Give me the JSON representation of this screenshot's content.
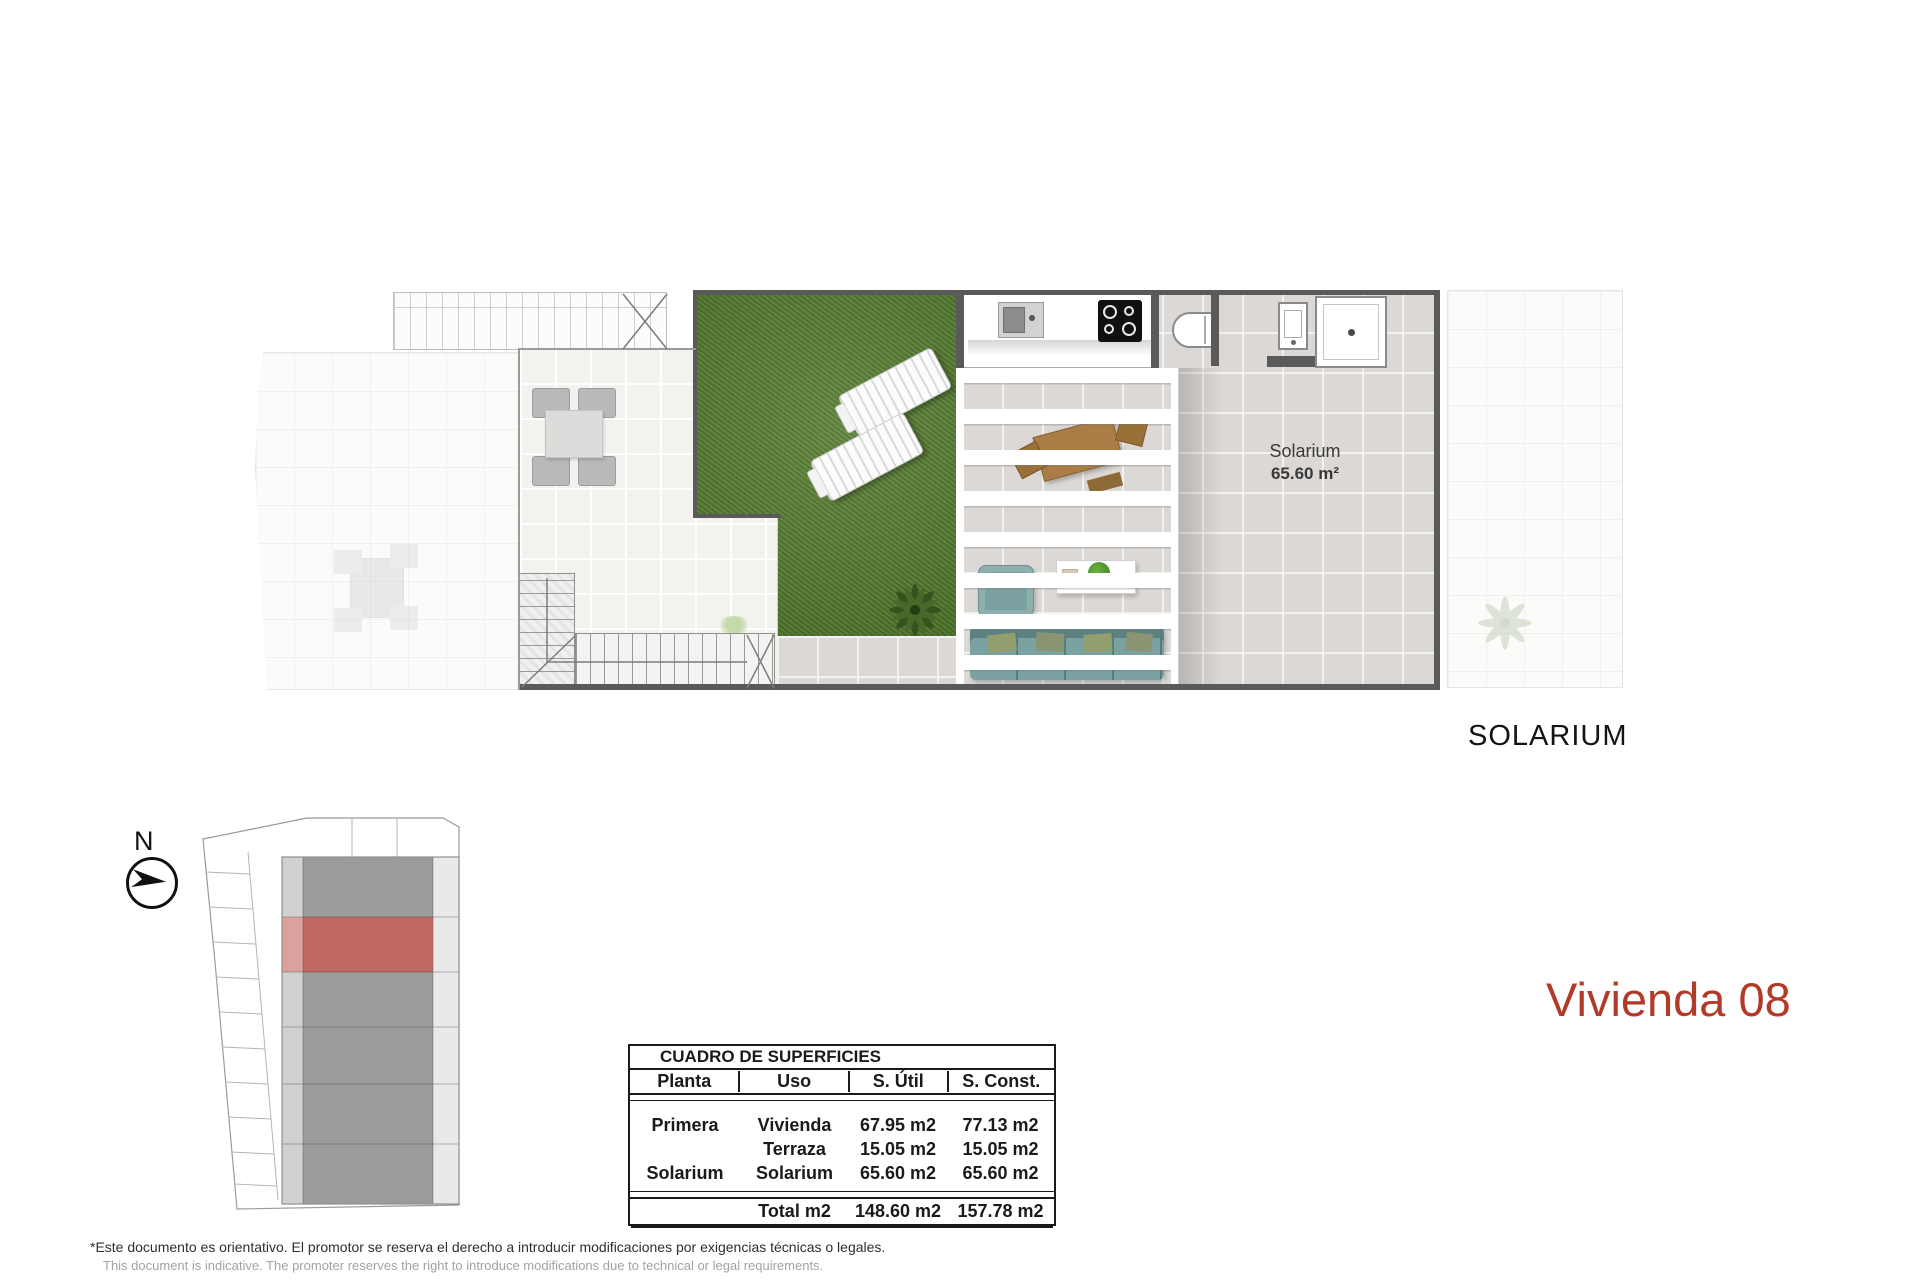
{
  "page": {
    "plan_caption": "SOLARIUM",
    "title": "Vivienda 08",
    "compass_label": "N"
  },
  "floor_plan": {
    "room_label": "Solarium",
    "room_area": "65.60 m²"
  },
  "surface_table": {
    "title": "CUADRO DE SUPERFICIES",
    "headers": [
      "Planta",
      "Uso",
      "S. Útil",
      "S. Const."
    ],
    "rows": [
      {
        "planta": "Primera",
        "uso": "Vivienda",
        "util": "67.95 m2",
        "construida": "77.13 m2"
      },
      {
        "planta": "",
        "uso": "Terraza",
        "util": "15.05 m2",
        "construida": "15.05 m2"
      },
      {
        "planta": "Solarium",
        "uso": "Solarium",
        "util": "65.60 m2",
        "construida": "65.60 m2"
      }
    ],
    "total_label": "Total m2",
    "total_util": "148.60 m2",
    "total_construida": "157.78 m2"
  },
  "footer": {
    "disclaimer_es": "*Este documento es orientativo. El promotor se reserva el derecho a introducir modificaciones por exigencias técnicas o legales.",
    "disclaimer_en": "This document is indicative. The promoter reserves the right to introduce modifications due to technical or legal requirements."
  },
  "colors": {
    "title_red": "#b23a28",
    "highlight_red": "#c16862",
    "highlight_red_light": "#dca19c",
    "grass_green": "#547d2c",
    "sofa_teal": "#7ca1a1",
    "building_dark_gray": "#9b9b9b",
    "building_light_gray": "#e9e9e9",
    "wall_gray": "#5a5a5a"
  }
}
